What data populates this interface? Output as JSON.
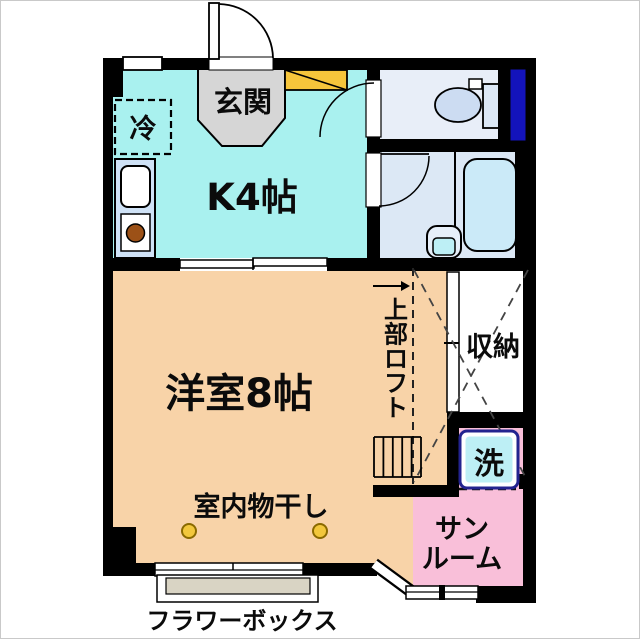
{
  "floor_plan": {
    "labels": {
      "entrance": "玄関",
      "refrigerator": "冷",
      "kitchen": "K4帖",
      "western_room": "洋室8帖",
      "indoor_drying": "室内物干し",
      "upper_loft": "上部ロフト",
      "closet": "収納",
      "washing_machine": "洗",
      "sunroom_line1": "サン",
      "sunroom_line2": "ルーム",
      "flower_box": "フラワーボックス"
    },
    "colors": {
      "wall": "#000000",
      "kitchen": "#A9F1EF",
      "western_room": "#F8D3A8",
      "sunroom_pink": "#F9BFD9",
      "bath_floor": "#DCE8F5",
      "toilet_floor": "#E8EEF8",
      "bathtub": "#CBEAF8",
      "toilet_bowl": "#CCDCF2",
      "toilet_tank": "#DCE8F6",
      "closet_white": "#FFFFFF",
      "entrance_gray": "#D6D6D6",
      "shoe_box": "#F6C53B",
      "window_glass": "#1313BB",
      "counter": "#CFE2F6",
      "burner": "#9C5117",
      "hook": "#F2C73C",
      "flower_box_fill": "#D9D4C4",
      "washer_fill": "#BDEFF5",
      "washer_border": "#23238F",
      "basin_outer": "#E6EFF9",
      "basin_inner": "#BDEFF5"
    }
  }
}
